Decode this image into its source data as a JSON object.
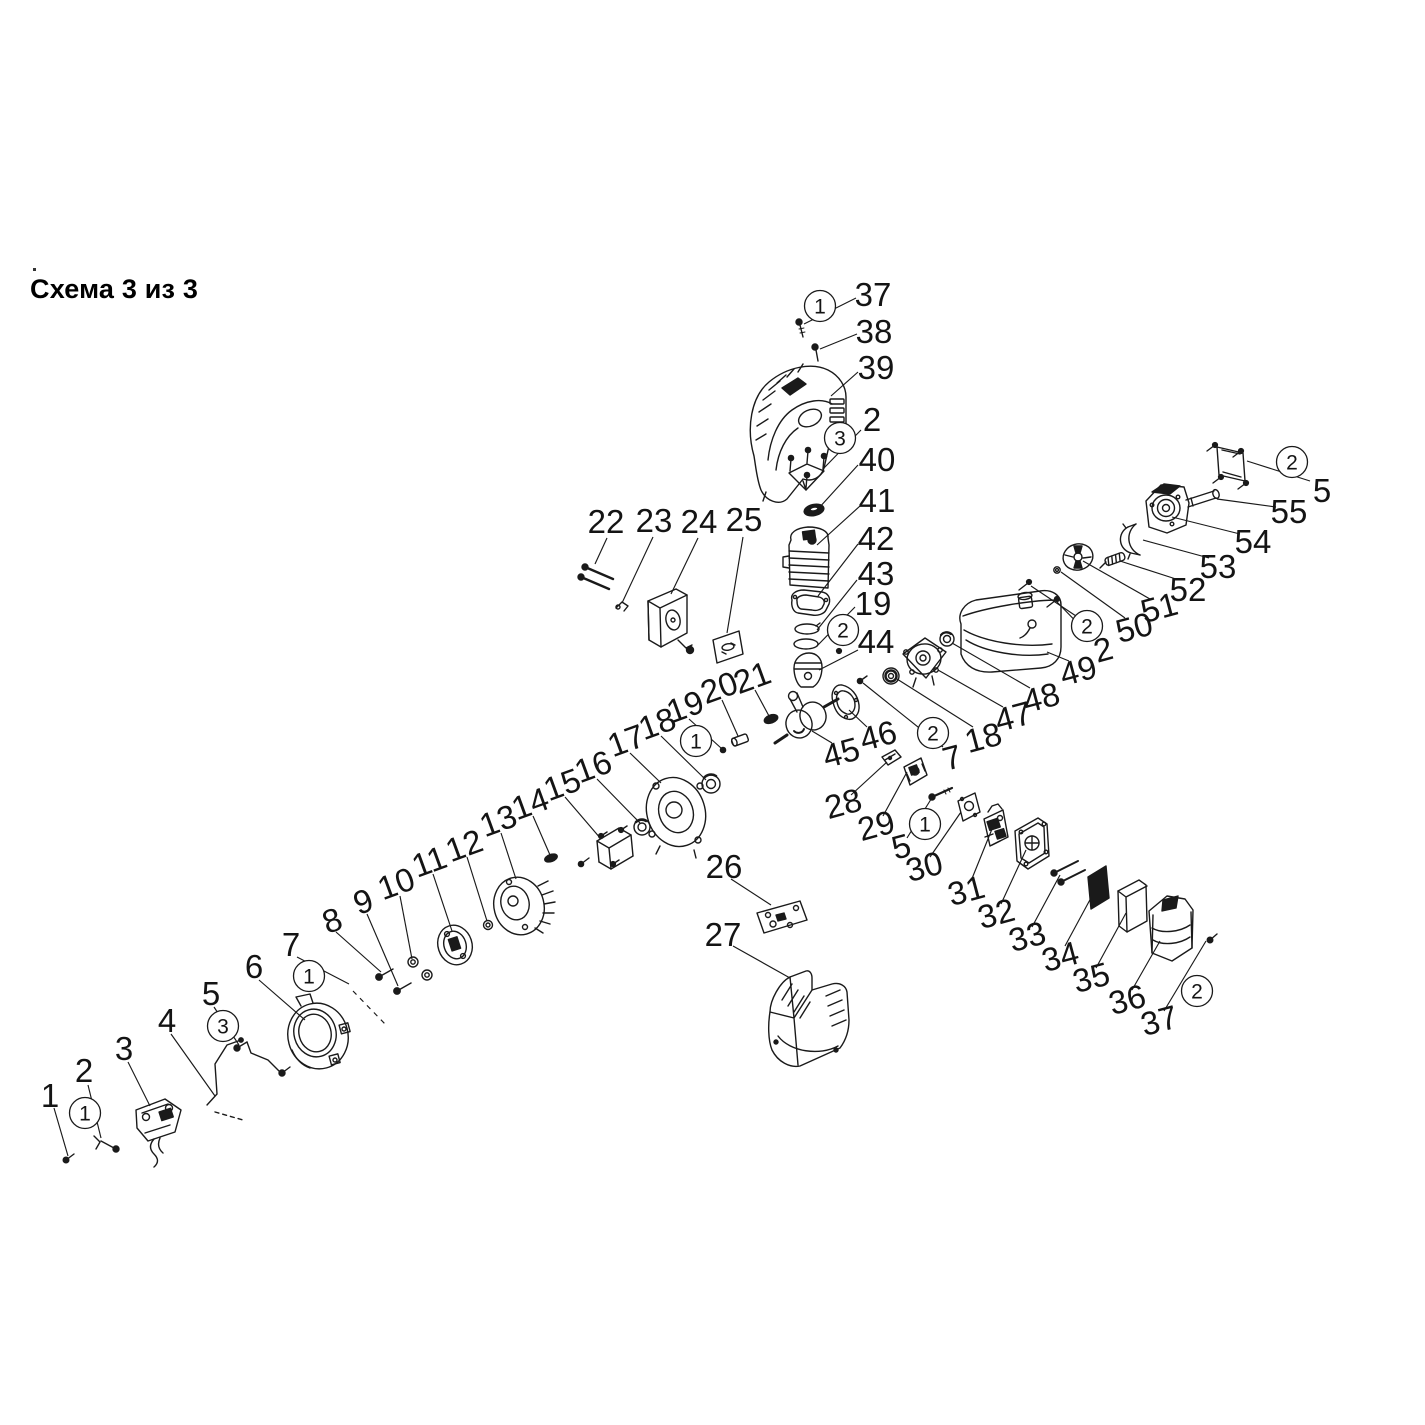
{
  "title": "Схема 3 из 3",
  "colors": {
    "ink": "#1a1a1a",
    "background": "#ffffff"
  },
  "diagram": {
    "label_font_size": 33,
    "marker_radius": 15.5,
    "part_labels": [
      {
        "n": "1",
        "x": 50,
        "y": 1095,
        "r": 0
      },
      {
        "n": "2",
        "x": 84,
        "y": 1070,
        "r": 0
      },
      {
        "n": "3",
        "x": 124,
        "y": 1048,
        "r": 0
      },
      {
        "n": "4",
        "x": 167,
        "y": 1020,
        "r": 0
      },
      {
        "n": "5",
        "x": 211,
        "y": 993,
        "r": 0
      },
      {
        "n": "6",
        "x": 254,
        "y": 966,
        "r": 0
      },
      {
        "n": "7",
        "x": 291,
        "y": 944,
        "r": 0
      },
      {
        "n": "8",
        "x": 332,
        "y": 920,
        "r": -20
      },
      {
        "n": "9",
        "x": 363,
        "y": 901,
        "r": -20
      },
      {
        "n": "10",
        "x": 396,
        "y": 883,
        "r": -20
      },
      {
        "n": "11",
        "x": 429,
        "y": 861,
        "r": -20
      },
      {
        "n": "12",
        "x": 464,
        "y": 845,
        "r": -20
      },
      {
        "n": "13",
        "x": 498,
        "y": 820,
        "r": -20
      },
      {
        "n": "14",
        "x": 530,
        "y": 803,
        "r": -20
      },
      {
        "n": "15",
        "x": 562,
        "y": 784,
        "r": -20
      },
      {
        "n": "16",
        "x": 593,
        "y": 766,
        "r": -20
      },
      {
        "n": "17",
        "x": 626,
        "y": 740,
        "r": -20
      },
      {
        "n": "18",
        "x": 657,
        "y": 723,
        "r": -20
      },
      {
        "n": "19",
        "x": 685,
        "y": 706,
        "r": -20
      },
      {
        "n": "20",
        "x": 719,
        "y": 687,
        "r": -20
      },
      {
        "n": "21",
        "x": 752,
        "y": 677,
        "r": -20
      },
      {
        "n": "22",
        "x": 606,
        "y": 521,
        "r": 0
      },
      {
        "n": "23",
        "x": 654,
        "y": 520,
        "r": 0
      },
      {
        "n": "24",
        "x": 699,
        "y": 521,
        "r": 0
      },
      {
        "n": "25",
        "x": 744,
        "y": 519,
        "r": 0
      },
      {
        "n": "26",
        "x": 724,
        "y": 866,
        "r": 0
      },
      {
        "n": "27",
        "x": 723,
        "y": 934,
        "r": 0
      },
      {
        "n": "28",
        "x": 843,
        "y": 803,
        "r": -15
      },
      {
        "n": "29",
        "x": 876,
        "y": 825,
        "r": -15
      },
      {
        "n": "5",
        "x": 901,
        "y": 846,
        "r": -15
      },
      {
        "n": "30",
        "x": 924,
        "y": 866,
        "r": -15
      },
      {
        "n": "31",
        "x": 966,
        "y": 890,
        "r": -15
      },
      {
        "n": "32",
        "x": 996,
        "y": 913,
        "r": -15
      },
      {
        "n": "33",
        "x": 1027,
        "y": 936,
        "r": -15
      },
      {
        "n": "34",
        "x": 1060,
        "y": 956,
        "r": -15
      },
      {
        "n": "35",
        "x": 1091,
        "y": 977,
        "r": -15
      },
      {
        "n": "36",
        "x": 1127,
        "y": 999,
        "r": -15
      },
      {
        "n": "37",
        "x": 1159,
        "y": 1020,
        "r": -15
      },
      {
        "n": "37",
        "x": 873,
        "y": 294,
        "r": 0
      },
      {
        "n": "38",
        "x": 874,
        "y": 331,
        "r": 0
      },
      {
        "n": "39",
        "x": 876,
        "y": 367,
        "r": 0
      },
      {
        "n": "2",
        "x": 872,
        "y": 419,
        "r": 0
      },
      {
        "n": "40",
        "x": 877,
        "y": 459,
        "r": 0
      },
      {
        "n": "41",
        "x": 877,
        "y": 500,
        "r": 0
      },
      {
        "n": "42",
        "x": 876,
        "y": 538,
        "r": 0
      },
      {
        "n": "43",
        "x": 876,
        "y": 573,
        "r": 0
      },
      {
        "n": "19",
        "x": 873,
        "y": 603,
        "r": 0
      },
      {
        "n": "44",
        "x": 876,
        "y": 641,
        "r": 0
      },
      {
        "n": "45",
        "x": 841,
        "y": 752,
        "r": -15
      },
      {
        "n": "46",
        "x": 878,
        "y": 735,
        "r": -15
      },
      {
        "n": "7",
        "x": 952,
        "y": 757,
        "r": -15
      },
      {
        "n": "18",
        "x": 983,
        "y": 737,
        "r": -15
      },
      {
        "n": "47",
        "x": 1013,
        "y": 716,
        "r": -15
      },
      {
        "n": "48",
        "x": 1041,
        "y": 697,
        "r": -15
      },
      {
        "n": "49",
        "x": 1078,
        "y": 670,
        "r": -15
      },
      {
        "n": "2",
        "x": 1103,
        "y": 649,
        "r": -15
      },
      {
        "n": "50",
        "x": 1134,
        "y": 627,
        "r": -15
      },
      {
        "n": "51",
        "x": 1159,
        "y": 607,
        "r": -15
      },
      {
        "n": "52",
        "x": 1188,
        "y": 589,
        "r": 0
      },
      {
        "n": "53",
        "x": 1218,
        "y": 566,
        "r": 0
      },
      {
        "n": "54",
        "x": 1253,
        "y": 541,
        "r": 0
      },
      {
        "n": "55",
        "x": 1289,
        "y": 511,
        "r": 0
      },
      {
        "n": "5",
        "x": 1322,
        "y": 490,
        "r": 0
      }
    ],
    "circled_markers": [
      {
        "n": "1",
        "x": 820,
        "y": 306
      },
      {
        "n": "3",
        "x": 840,
        "y": 438
      },
      {
        "n": "2",
        "x": 843,
        "y": 630
      },
      {
        "n": "2",
        "x": 933,
        "y": 733
      },
      {
        "n": "1",
        "x": 696,
        "y": 741
      },
      {
        "n": "1",
        "x": 925,
        "y": 824
      },
      {
        "n": "2",
        "x": 1087,
        "y": 626
      },
      {
        "n": "2",
        "x": 1292,
        "y": 462
      },
      {
        "n": "2",
        "x": 1197,
        "y": 991
      },
      {
        "n": "1",
        "x": 309,
        "y": 976
      },
      {
        "n": "3",
        "x": 223,
        "y": 1026
      },
      {
        "n": "1",
        "x": 85,
        "y": 1113
      }
    ],
    "leaders": [
      [
        54,
        1108,
        68,
        1156,
        0
      ],
      [
        88,
        1085,
        101,
        1138,
        0
      ],
      [
        128,
        1062,
        150,
        1106,
        0
      ],
      [
        171,
        1034,
        215,
        1096,
        0
      ],
      [
        214,
        1007,
        239,
        1045,
        0
      ],
      [
        259,
        980,
        305,
        1020,
        0
      ],
      [
        297,
        957,
        349,
        984,
        0
      ],
      [
        353,
        991,
        386,
        1025,
        1
      ],
      [
        336,
        932,
        381,
        972,
        0
      ],
      [
        367,
        914,
        398,
        986,
        0
      ],
      [
        400,
        896,
        412,
        959,
        0
      ],
      [
        433,
        874,
        452,
        931,
        0
      ],
      [
        467,
        857,
        487,
        921,
        0
      ],
      [
        501,
        833,
        516,
        879,
        0
      ],
      [
        533,
        816,
        550,
        855,
        0
      ],
      [
        565,
        797,
        601,
        839,
        0
      ],
      [
        597,
        779,
        640,
        823,
        0
      ],
      [
        630,
        753,
        661,
        783,
        0
      ],
      [
        661,
        736,
        706,
        780,
        0
      ],
      [
        689,
        719,
        721,
        748,
        0
      ],
      [
        722,
        700,
        738,
        736,
        0
      ],
      [
        755,
        690,
        769,
        716,
        0
      ],
      [
        607,
        538,
        595,
        564,
        0
      ],
      [
        653,
        537,
        622,
        603,
        0
      ],
      [
        698,
        538,
        671,
        594,
        0
      ],
      [
        743,
        537,
        727,
        633,
        0
      ],
      [
        731,
        879,
        771,
        905,
        0
      ],
      [
        733,
        946,
        790,
        978,
        0
      ],
      [
        851,
        795,
        887,
        762,
        0
      ],
      [
        883,
        816,
        907,
        772,
        0
      ],
      [
        907,
        838,
        933,
        796,
        0
      ],
      [
        930,
        857,
        961,
        812,
        0
      ],
      [
        971,
        881,
        992,
        829,
        0
      ],
      [
        1001,
        904,
        1026,
        850,
        0
      ],
      [
        1032,
        927,
        1060,
        875,
        0
      ],
      [
        1065,
        946,
        1092,
        896,
        0
      ],
      [
        1096,
        968,
        1126,
        913,
        0
      ],
      [
        1132,
        990,
        1160,
        941,
        0
      ],
      [
        1164,
        1011,
        1206,
        941,
        0
      ],
      [
        856,
        298,
        804,
        324,
        0
      ],
      [
        857,
        334,
        820,
        349,
        0
      ],
      [
        858,
        372,
        831,
        396,
        0
      ],
      [
        861,
        430,
        824,
        468,
        0
      ],
      [
        858,
        465,
        818,
        509,
        0
      ],
      [
        860,
        506,
        817,
        545,
        0
      ],
      [
        858,
        544,
        818,
        596,
        0
      ],
      [
        857,
        580,
        817,
        630,
        0
      ],
      [
        855,
        607,
        817,
        646,
        0
      ],
      [
        858,
        650,
        819,
        670,
        0
      ],
      [
        832,
        743,
        812,
        731,
        0
      ],
      [
        867,
        727,
        849,
        710,
        0
      ],
      [
        943,
        747,
        863,
        683,
        0
      ],
      [
        973,
        727,
        897,
        679,
        0
      ],
      [
        1003,
        707,
        938,
        670,
        0
      ],
      [
        1030,
        688,
        952,
        643,
        0
      ],
      [
        1069,
        661,
        1047,
        652,
        0
      ],
      [
        1093,
        639,
        1057,
        602,
        0
      ],
      [
        1076,
        616,
        1031,
        586,
        0
      ],
      [
        1125,
        618,
        1061,
        572,
        0
      ],
      [
        1150,
        599,
        1083,
        561,
        0
      ],
      [
        1179,
        580,
        1120,
        561,
        0
      ],
      [
        1209,
        558,
        1143,
        540,
        0
      ],
      [
        1240,
        534,
        1172,
        517,
        0
      ],
      [
        1276,
        507,
        1217,
        499,
        0
      ],
      [
        1310,
        481,
        1247,
        461,
        0
      ]
    ]
  }
}
